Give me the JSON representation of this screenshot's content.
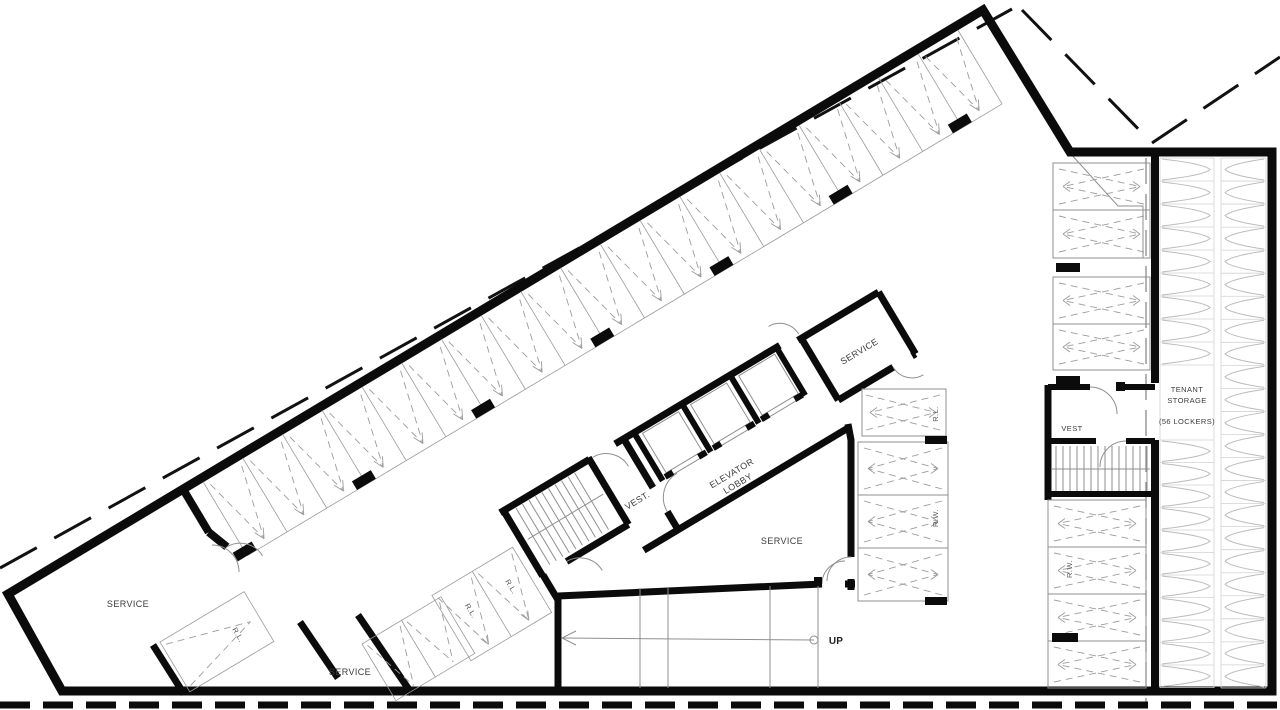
{
  "labels": {
    "service": "SERVICE",
    "elevator_line1": "ELEVATOR",
    "elevator_line2": "LOBBY",
    "vest_core": "VEST.",
    "vest_right": "VEST",
    "storage_line1": "TENANT",
    "storage_line2": "STORAGE",
    "storage_count": "(56 LOCKERS)",
    "up": "UP",
    "rl": "R.L.",
    "rw": "R.W."
  },
  "colors": {
    "wall": "#0b0b0b",
    "thin_line": "#8f8f8f",
    "stripe": "#9c9c9c",
    "locker": "#bcbcbc",
    "text": "#3b3b3b",
    "background": "#ffffff"
  },
  "layout_hints": {
    "top_row_stalls": 19,
    "top_row_columns": 7,
    "mid_right_stalls": 4,
    "far_right_stalls": 4,
    "upper_right_stalls": 4,
    "elevator_cabs": 3,
    "storage_locker_rows_left": 20,
    "storage_locker_rows_right": 23
  }
}
